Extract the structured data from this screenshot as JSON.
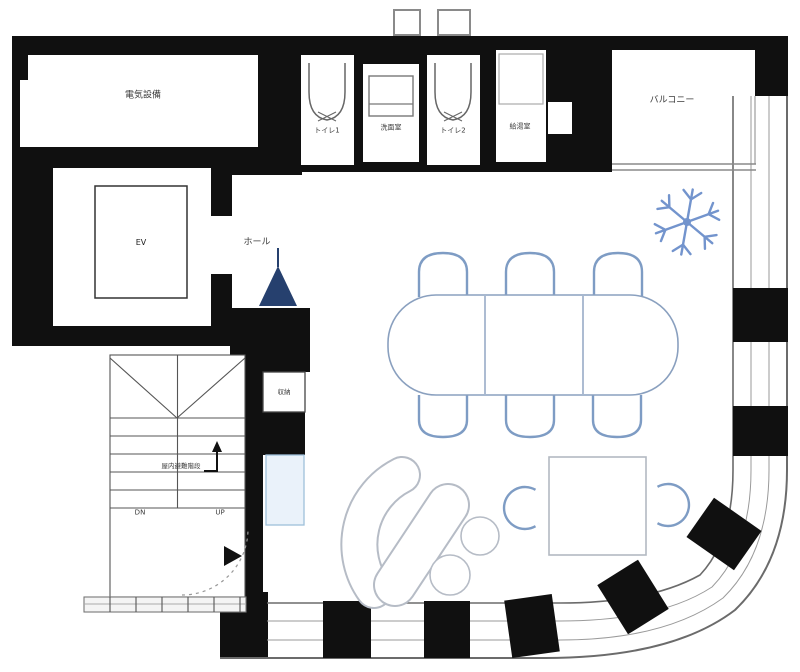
{
  "plan": {
    "title": "Office floor plan",
    "rooms": {
      "electrical_room": {
        "label": "電気設備"
      },
      "toilet1": {
        "label": "トイレ1"
      },
      "washroom": {
        "label": "洗面室"
      },
      "toilet2": {
        "label": "トイレ2"
      },
      "kitchenette": {
        "label": "給湯室"
      },
      "balcony": {
        "label": "バルコニー"
      },
      "elevator": {
        "label": "EV"
      },
      "hall": {
        "label": "ホール"
      },
      "storage": {
        "label": "収納"
      }
    },
    "stairwell": {
      "label": "屋内避難階段",
      "down_label": "DN",
      "up_label": "UP"
    },
    "furniture": {
      "conference_table_seats": 6,
      "square_table_seats": 2,
      "sofa_pieces": 4
    },
    "colors": {
      "wall_black": "#101010",
      "line_gray": "#6b6b6b",
      "mullion_gray": "#9a9a9a",
      "furniture_blue": "#7e9cc4",
      "furniture_gray": "#b6bcc6",
      "accent_navy": "#26406e",
      "snowflake_blue": "#7394cd",
      "light_blue_fill": "#eaf2fa"
    }
  }
}
